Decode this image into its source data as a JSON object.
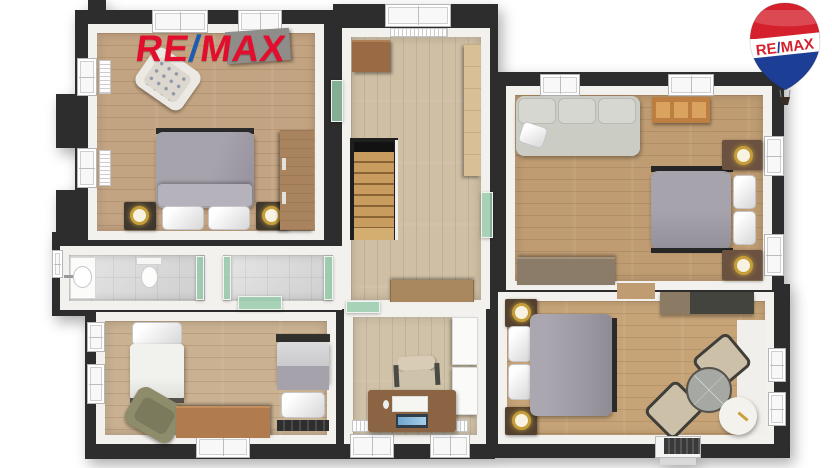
{
  "brand": {
    "name": "RE/MAX",
    "wordmark": {
      "re": "RE",
      "slash": "/",
      "max": "MAX"
    },
    "balloon": {
      "re": "RE",
      "slash": "/",
      "max": "MAX"
    },
    "colors": {
      "logo_red": "#e30e2d",
      "logo_blue": "#1c5cb3",
      "balloon_red": "#d5212e",
      "balloon_blue": "#1c3e94",
      "balloon_white": "#ffffff"
    }
  },
  "floorplan": {
    "view": "3d-top-down-render",
    "style": {
      "outer_wall": "#2e2d2d",
      "inner_wall": "#f3f1ee",
      "glass_door": "#97cbab",
      "tile_floor": "#d8d9d8",
      "brass_lamp": "#c59e3a"
    },
    "rooms": [
      {
        "name": "bedroom-top-left",
        "floor": "#c3a482",
        "furniture": [
          "patterned-armchair",
          "gray-wardrobe-top",
          "double-bed",
          "pillow",
          "pillow",
          "nightstand-with-lamp",
          "nightstand-with-lamp",
          "wood-wardrobe"
        ]
      },
      {
        "name": "hallway-with-stairs",
        "floor": "#cfbfa4",
        "furniture": [
          "small-cabinet",
          "tall-shelf",
          "staircase",
          "sideboard"
        ]
      },
      {
        "name": "living-room-with-bed",
        "floor": "#bf9c72",
        "furniture": [
          "sofa",
          "throw-pillow",
          "media-cabinet",
          "double-bed",
          "pillow",
          "pillow",
          "nightstand-with-lamp",
          "nightstand-with-lamp",
          "sideboard"
        ]
      },
      {
        "name": "bedroom-bottom-right",
        "floor": "#c6a478",
        "furniture": [
          "double-bed",
          "pillow",
          "pillow",
          "nightstand-with-lamp",
          "nightstand-with-lamp",
          "wall-console",
          "round-glass-table",
          "chair",
          "chair",
          "round-side-table"
        ]
      },
      {
        "name": "bathroom",
        "floor": "#d8d9d8",
        "furniture": [
          "washbasin-counter",
          "toilet",
          "shower-glass-panel"
        ]
      },
      {
        "name": "vestibule",
        "floor": "#d8d9d8",
        "furniture": [
          "glass-door",
          "glass-door",
          "glass-door"
        ]
      },
      {
        "name": "bedroom-bottom-left",
        "floor": "#c9b191",
        "furniture": [
          "single-bed-white",
          "olive-armchair",
          "wood-chest",
          "single-bed-gray"
        ]
      },
      {
        "name": "office",
        "floor": "#d0c2a8",
        "furniture": [
          "white-cabinet",
          "desk",
          "laptop",
          "paper",
          "mouse",
          "office-chair"
        ]
      }
    ],
    "openings": [
      "entry-door-bottom",
      "glass-door-count-6",
      "window-count-17"
    ]
  }
}
